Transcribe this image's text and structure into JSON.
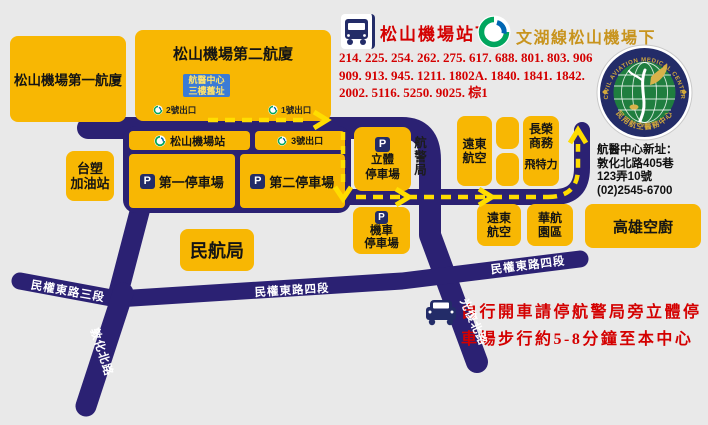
{
  "symbols": {
    "parking": "P"
  },
  "header": {
    "bus_stop": "松山機場站下",
    "metro_line": "文湖線松山機場下",
    "bus_routes": [
      "214. 225. 254. 262. 275. 617. 688. 801. 803. 906",
      "909. 913. 945. 1211. 1802A. 1840. 1841. 1842.",
      "2002. 5116. 5250. 9025. 棕1"
    ]
  },
  "logo": {
    "ring_top": "CIVIL AVIATION MEDICAL CENTER",
    "ring_bottom": "民用航空醫務中心"
  },
  "address": {
    "line1": "航醫中心新址：",
    "line2": "敦化北路405巷",
    "line3": "123弄10號",
    "line4": "(02)2545-6700"
  },
  "map": {
    "terminal1": "松山機場第一航廈",
    "terminal2": "松山機場第二航廈",
    "old_site": {
      "line1": "航醫中心",
      "line2": "三樓舊址"
    },
    "exit1": "1號出口",
    "exit2": "2號出口",
    "exit3": "3號出口",
    "metro_station": "松山機場站",
    "parking_lot1": "第一停車場",
    "parking_lot2": "第二停車場",
    "gas_station": {
      "line1": "台塑",
      "line2": "加油站"
    },
    "multilevel_parking": {
      "line1": "立體",
      "line2": "停車場"
    },
    "aviation_police": "航警局",
    "fareast_air_top": {
      "line1": "遠東",
      "line2": "航空"
    },
    "eva": {
      "line1": "長榮",
      "line2": "商務"
    },
    "fitel": "飛特力",
    "moto_parking": {
      "line1": "機車",
      "line2": "停車場"
    },
    "fareast_air_bottom": {
      "line1": "遠東",
      "line2": "航空"
    },
    "china_airlines_park": {
      "line1": "華航",
      "line2": "園區"
    },
    "kaohsiung_catering": "高雄空廚",
    "caa": "民航局"
  },
  "roads": {
    "minquan_e3": "民權東路三段",
    "minquan_e4_left": "民權東路四段",
    "minquan_e4_right": "民權東路四段",
    "dunhua_n": "敦化北路",
    "guangfu_n": "光復北路"
  },
  "note": {
    "line1": "自行開車請停航警局旁立體停",
    "line2": "車場步行約5-8分鐘至本中心"
  },
  "colors": {
    "road": "#2B2173",
    "building": "#F8B703",
    "route_dash": "#FFDD00",
    "red_text": "#D40000",
    "orange_text": "#C8941E",
    "old_site_bg": "#3B7BD6"
  }
}
